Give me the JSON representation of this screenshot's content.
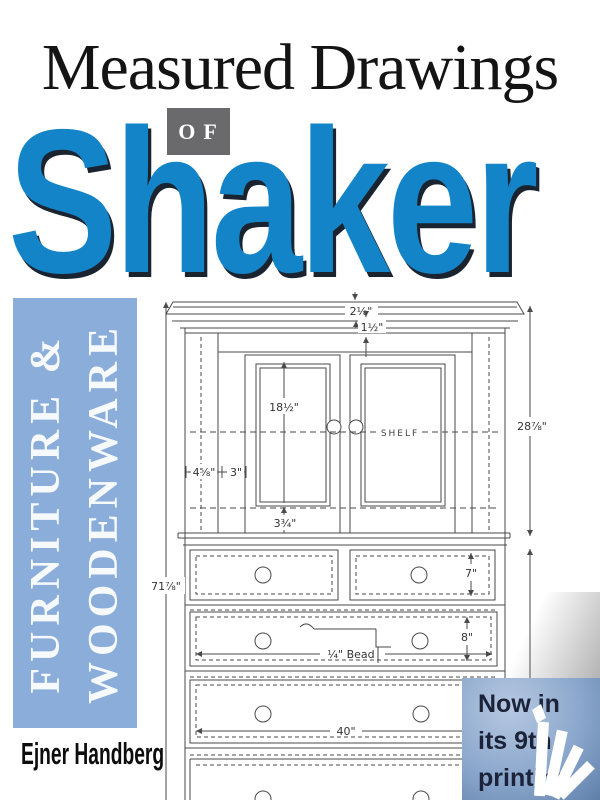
{
  "cover": {
    "title": "Measured Drawings",
    "of_label": "OF",
    "subject": "Shaker",
    "sidebar_line1": "FURNITURE &",
    "sidebar_line2": "WOODENWARE",
    "author": "Ejner Handberg",
    "badge": {
      "line1": "Now in",
      "line2": "its 9th",
      "line3": "printing"
    },
    "colors": {
      "shaker_blue": "#1484c8",
      "shaker_shadow": "#1a2430",
      "sidebar_blue": "#8badda",
      "badge_blue_light": "#b6c8e1",
      "badge_blue_dark": "#5d7ca6",
      "badge_text": "#1c2338",
      "of_box_gray": "#6a6a6c",
      "drawing_ink": "#4a4a4a"
    }
  },
  "drawing": {
    "shelf_label": "SHELF",
    "bead_label": "¼\" Bead",
    "dims": [
      {
        "name": "overall-height",
        "text": "71⅞\""
      },
      {
        "name": "upper-case-height",
        "text": "28⅞\""
      },
      {
        "name": "cornice-height",
        "text": "2⅛\""
      },
      {
        "name": "frieze-height",
        "text": "1½\""
      },
      {
        "name": "door-panel-height",
        "text": "18½\""
      },
      {
        "name": "door-bottom-rail",
        "text": "3¾\""
      },
      {
        "name": "stile-width",
        "text": "4⅝\""
      },
      {
        "name": "door-stile-width",
        "text": "3\""
      },
      {
        "name": "top-drawer-height",
        "text": "7\""
      },
      {
        "name": "second-drawer-height",
        "text": "8\""
      },
      {
        "name": "drawer-width",
        "text": "40\""
      }
    ]
  }
}
